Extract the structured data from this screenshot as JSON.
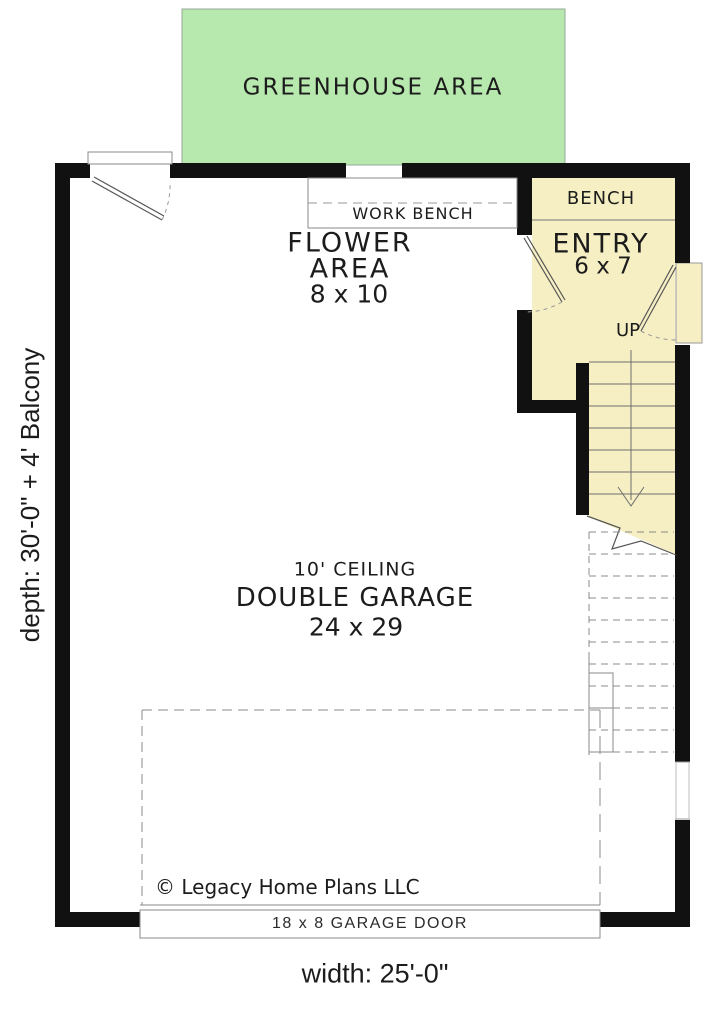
{
  "colors": {
    "green": "#b7e8ae",
    "yellow": "#f6efc3",
    "wall": "#111111",
    "line": "#777777",
    "ink": "#1c1c1c"
  },
  "labels": {
    "greenhouse": "GREENHOUSE AREA",
    "work_bench": "WORK BENCH",
    "flower1": "FLOWER",
    "flower2": "AREA",
    "flower3": "8 x 10",
    "bench": "BENCH",
    "entry1": "ENTRY",
    "entry2": "6 x 7",
    "up": "UP",
    "ceiling": "10' CEILING",
    "garage": "DOUBLE GARAGE",
    "garage_size": "24 x 29",
    "copyright": "© Legacy Home Plans LLC",
    "garage_door": "18 x 8 GARAGE DOOR",
    "width_dim": "width: 25'-0\"",
    "depth_dim": "depth: 30'-0\" + 4' Balcony"
  }
}
